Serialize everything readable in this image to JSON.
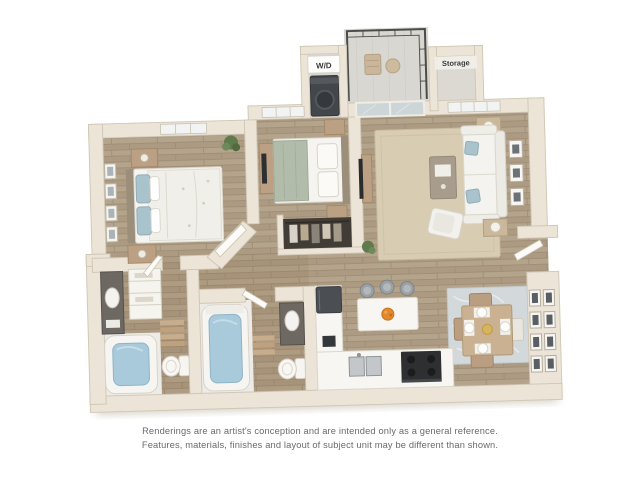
{
  "floor_plan": {
    "labels": {
      "washer_dryer": "W/D",
      "storage": "Storage"
    },
    "disclaimer": {
      "line1": "Renderings are an artist's conception and are intended only as a general reference.",
      "line2": "Features, materials, finishes and layout of subject unit may be different than shown."
    },
    "colors": {
      "background": "#ffffff",
      "wall": "#ebe4d7",
      "wall_edge": "#cfc6b4",
      "wood_floor": "#b4a48c",
      "bath_tile": "#edebe7",
      "tub_water": "#a9cadb",
      "living_rug": "#d8ccb3",
      "dining_rug": "#d3d8da",
      "appliance_dark": "#3c4043",
      "pillow_blue": "#a9c3cd",
      "wood_furniture": "#bca083",
      "fruit_bowl_orange": "#e2892e",
      "balcony_floor": "#d9d7d2",
      "disclaimer_text": "#6a6a6a"
    }
  }
}
